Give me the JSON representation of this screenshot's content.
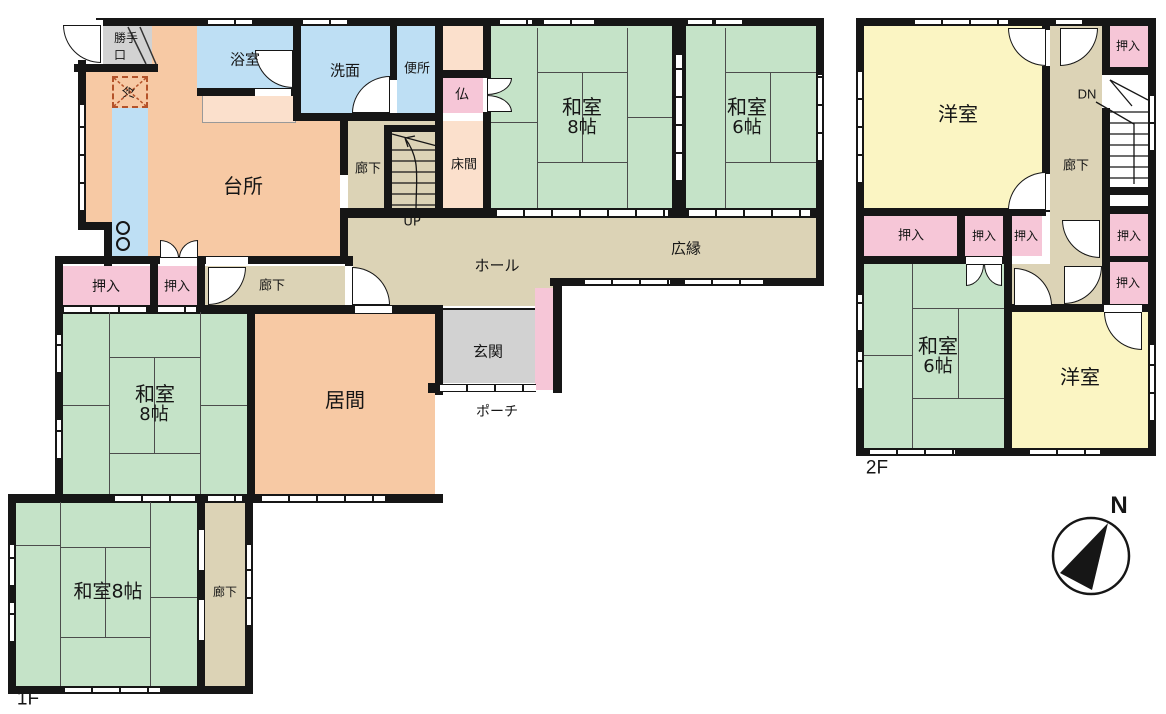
{
  "document": {
    "type": "floor-plan"
  },
  "floors": {
    "f1": {
      "label": "1F",
      "rooms": [
        "台所",
        "浴室",
        "洗面",
        "便所",
        "仏",
        "床間",
        "和室8帖",
        "和室6帖",
        "広縁",
        "ホール",
        "廊下",
        "押入",
        "居間",
        "玄関",
        "ポーチ",
        "勝手口",
        "冷",
        "UP",
        "和室8帖",
        "和室8帖"
      ]
    },
    "f2": {
      "label": "2F",
      "rooms": [
        "洋室",
        "廊下",
        "押入",
        "和室6帖",
        "洋室",
        "DN"
      ]
    }
  },
  "labels": {
    "katte1": "勝手",
    "katte2": "口",
    "rei": "冷",
    "bath": "浴室",
    "wash": "洗面",
    "toilet": "便所",
    "butsu": "仏",
    "kitchen": "台所",
    "tokonoma": "床間",
    "rouka": "廊下",
    "up": "UP",
    "dn": "DN",
    "hall": "ホール",
    "hiroen": "広縁",
    "washitsu": "和室",
    "s8": "8帖",
    "s6": "6帖",
    "washitsu8": "和室8帖",
    "oshiire": "押入",
    "ima": "居間",
    "genkan": "玄関",
    "porch": "ポーチ",
    "yoshitsu": "洋室",
    "f1": "1F",
    "f2": "2F",
    "north": "N"
  },
  "colors": {
    "tatami_green": "#c5e3c8",
    "room_peach": "#f7c9a4",
    "closet_pink": "#f6c6d7",
    "water_blue": "#bedff4",
    "corridor_tan": "#dcd3b6",
    "entry_gray": "#d2d2d2",
    "western_yellow": "#fbf5c3",
    "accent_light_peach": "#fbe0cc",
    "wall_black": "#161616"
  }
}
